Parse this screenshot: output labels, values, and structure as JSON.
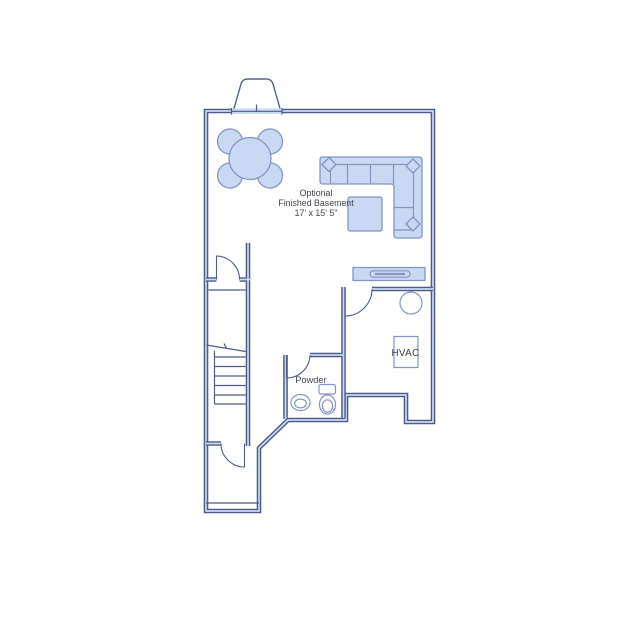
{
  "canvas": {
    "background": "#ffffff"
  },
  "floorplan": {
    "room_label": {
      "line1": "Optional",
      "line2": "Finished Basement",
      "line3": "17' x 15' 5\""
    },
    "powder_label": "Powder",
    "hvac_label": "HVAC",
    "colors": {
      "floor_fill": "#c9d9f3",
      "wall_stroke": "#4e5c87",
      "furniture_stroke": "#8395c0",
      "window_fill": "#ffffff",
      "label_color": "#42464d"
    },
    "symbols": [
      "egress-window-bay",
      "round-dining-table",
      "dining-chairs",
      "sectional-sofa",
      "throw-pillows",
      "ottoman",
      "media-console",
      "water-heater",
      "hvac-unit",
      "staircase",
      "doors",
      "toilet",
      "sink"
    ]
  }
}
